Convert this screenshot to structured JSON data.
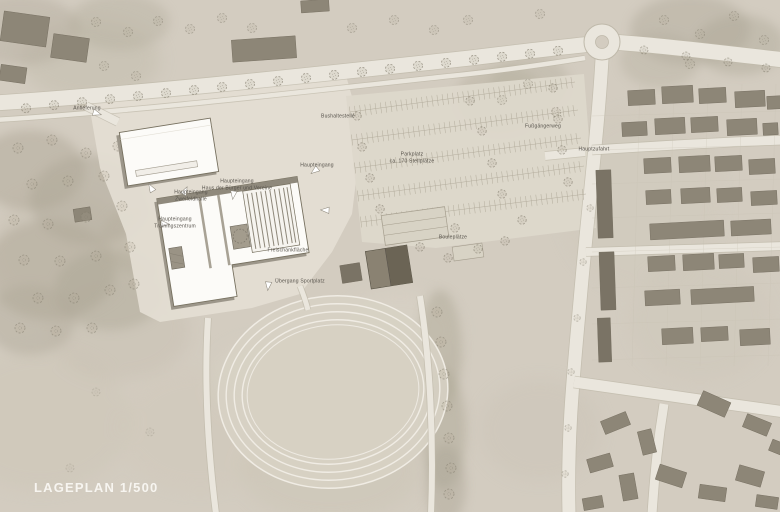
{
  "title": "LAGEPLAN 1/500",
  "map": {
    "legend": {
      "scale_label": "LAGEPLAN 1/500"
    },
    "labels": {
      "anlieferung": "Anlieferung",
      "entrance_zweifeldhalle": "Haupteingang\nZweifeldhalle",
      "entrance_haus": "Haupteingang\nHaus der Bürger und Vereine",
      "entrance_training": "Haupteingang\nTrainingszentrum",
      "haupteingang": "Haupteingang",
      "bushaltestelle": "Bushaltestelle",
      "parkplatz": "Parkplatz\nca. 170 Stellplätze",
      "fussgaengerweg": "Fußgängerweg",
      "hauptzufahrt": "Hauptzufahrt",
      "bouleplaetze": "Bouleplätze",
      "freischankflaeche": "Freischankfläche",
      "uebergang_sportplatz": "Übergang Sportplatz"
    },
    "colors": {
      "background": "#d3ccc0",
      "road": "#eae6dd",
      "plaza": "#e4dfd4",
      "building_existing": "#8d8677",
      "building_dark": "#6f6859",
      "building_new": "#fcfbf8",
      "label_text": "#55514a",
      "scale_text": "#f7f5f1"
    }
  }
}
